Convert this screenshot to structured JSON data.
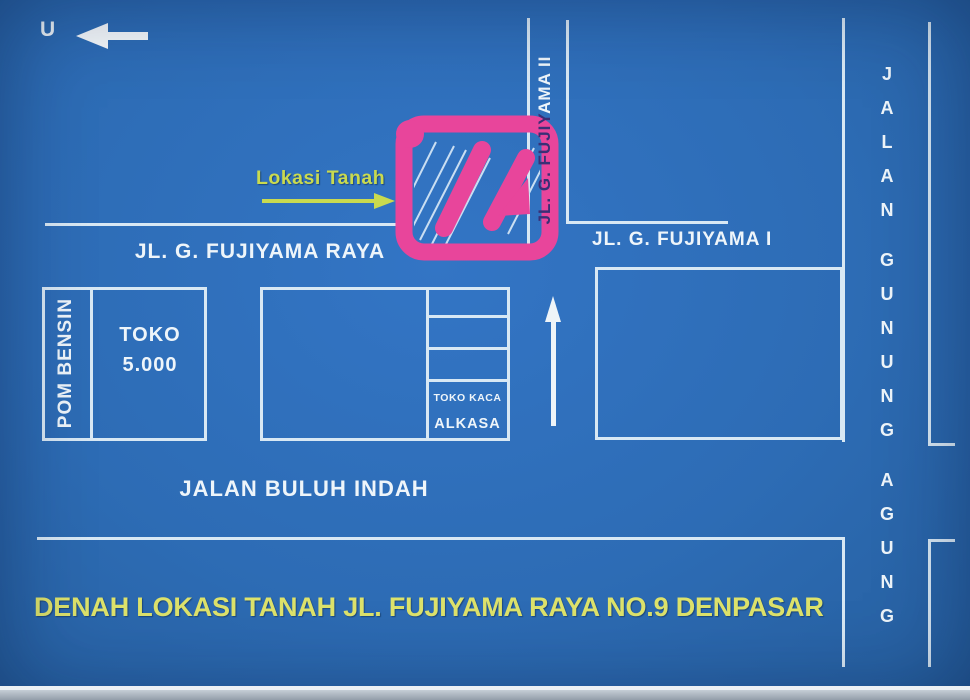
{
  "map": {
    "title": "DENAH LOKASI TANAH JL. FUJIYAMA RAYA NO.9 DENPASAR",
    "north_label": "U",
    "callout_label": "Lokasi Tanah",
    "roads": {
      "fujiyama_raya": "JL. G. FUJIYAMA RAYA",
      "fujiyama_i": "JL. G. FUJIYAMA I",
      "fujiyama_ii_covered": "JL. G. FUJIY",
      "fujiyama_ii_visible": "AMA II",
      "buluh_indah": "JALAN BULUH INDAH",
      "gunung_agung_word1": "JALAN",
      "gunung_agung_word2": "GUNUNG",
      "gunung_agung_word3": "AGUNG"
    },
    "places": {
      "pom_bensin": "POM BENSIN",
      "toko_5000_line1": "TOKO",
      "toko_5000_line2": "5.000",
      "toko_kaca": "TOKO KACA",
      "alkasa": "ALKASA"
    },
    "colors": {
      "background_blue": "#2d6cb5",
      "road_line": "#d8e8f4",
      "label_text": "#eef5fa",
      "plot_highlight_pink": "#e8459b",
      "title_yellow": "#dde26b",
      "callout_green": "#c9da4f",
      "covered_text_dark": "#3a2f76"
    }
  }
}
